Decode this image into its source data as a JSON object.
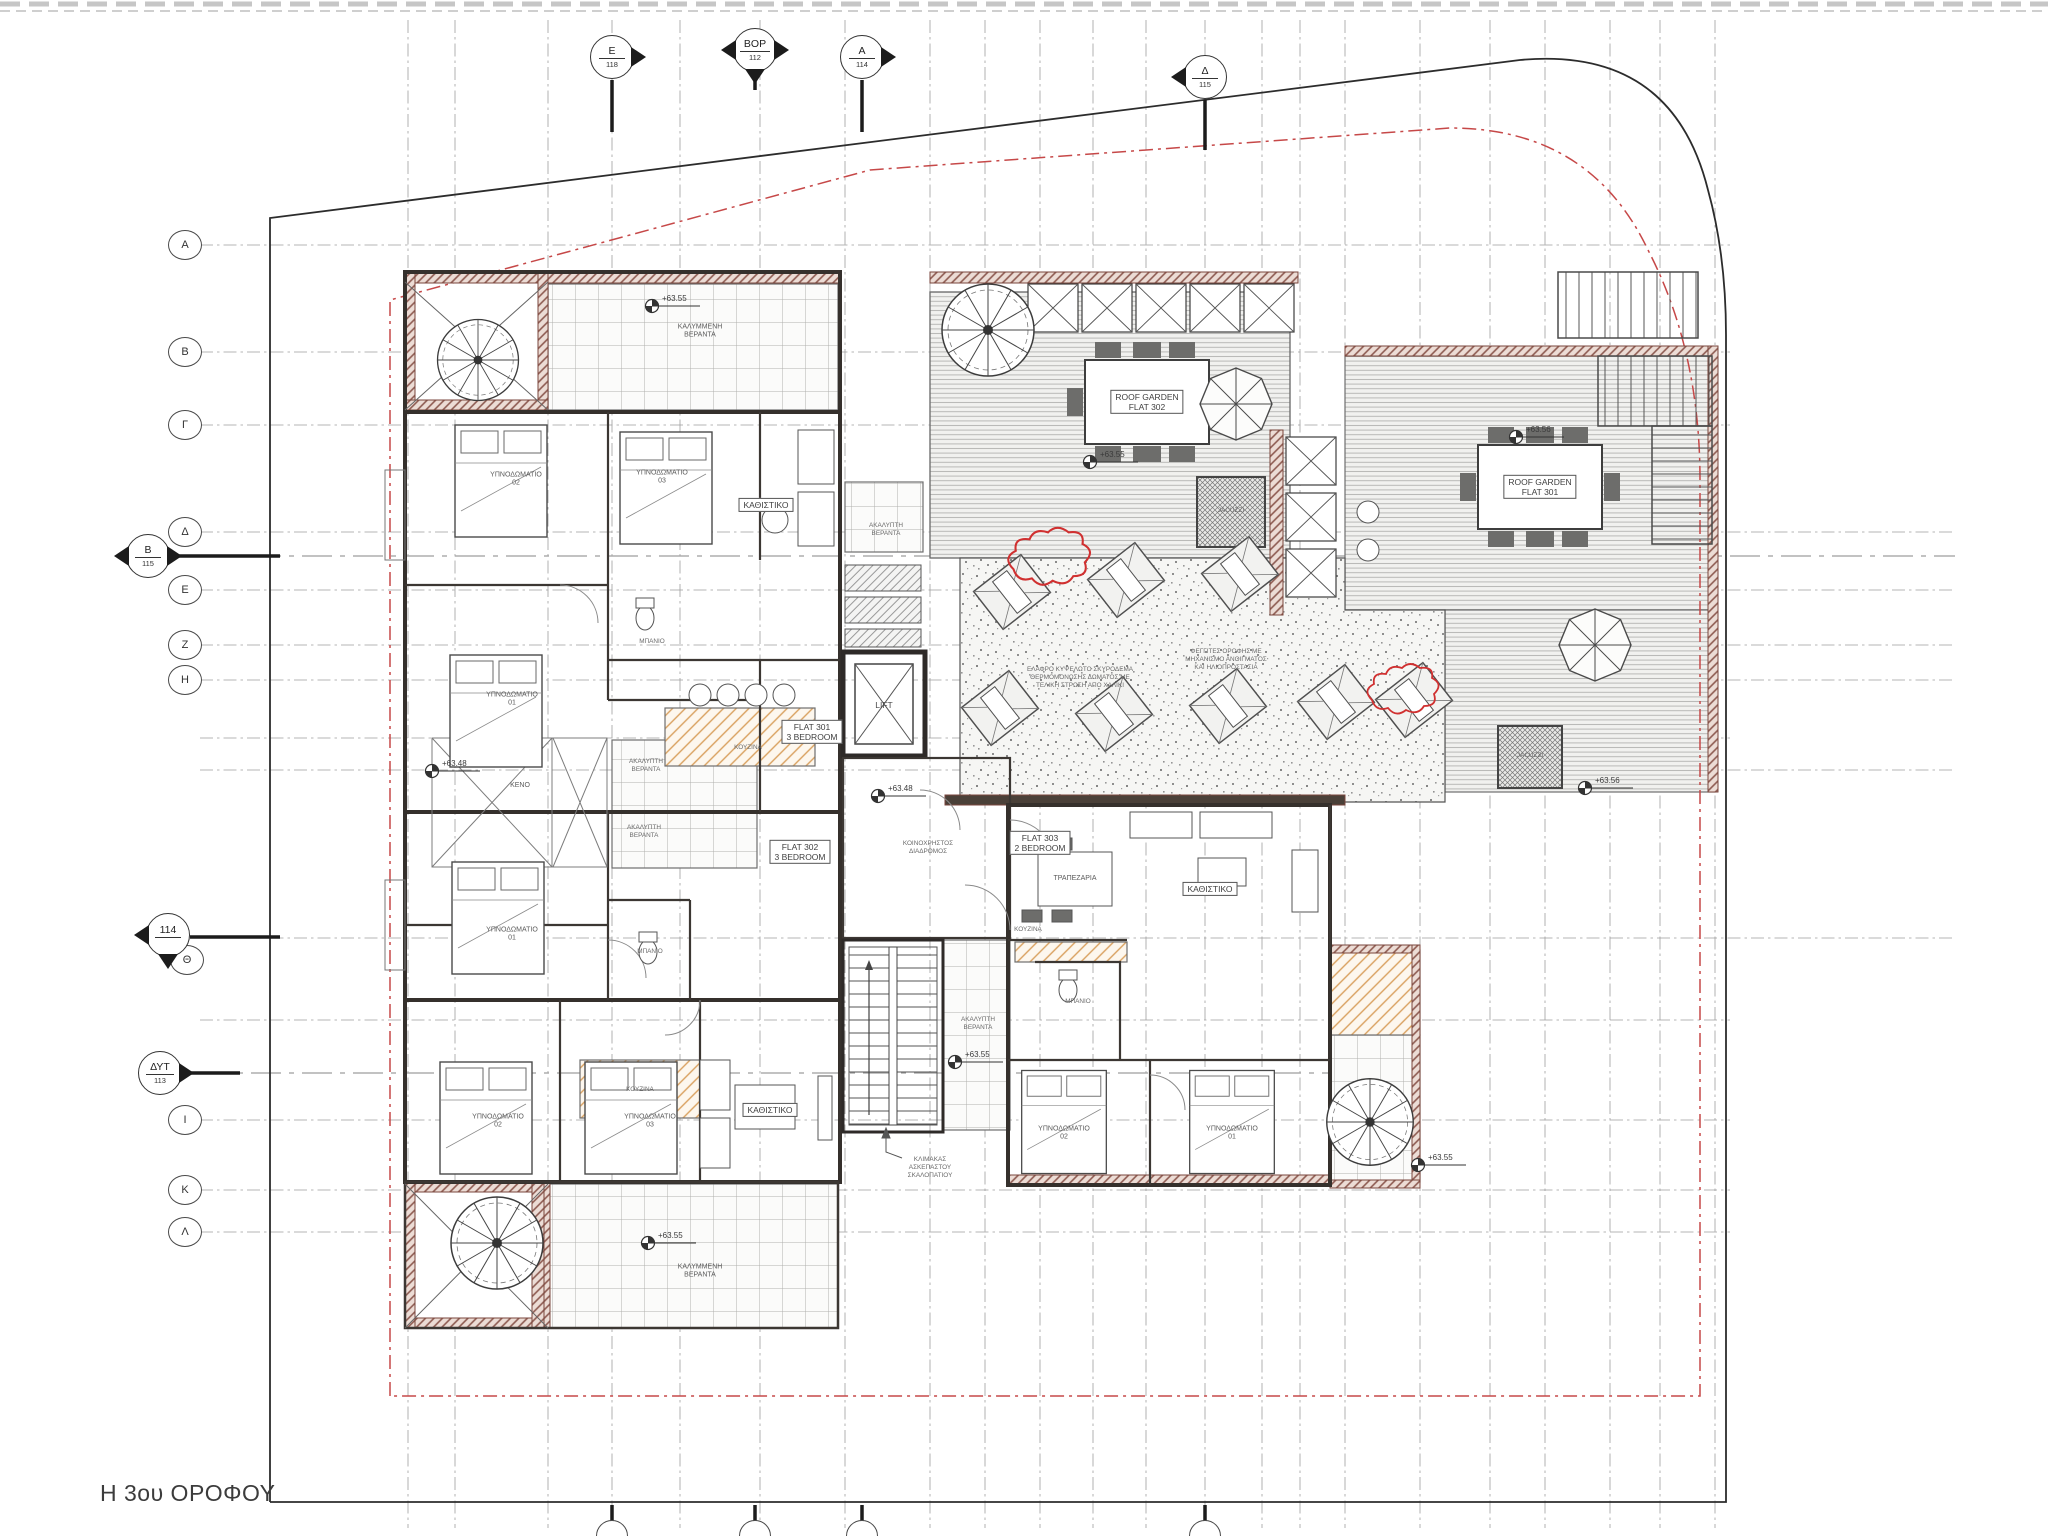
{
  "title": "Η 3ου ΟΡΟΦΟΥ",
  "grid": {
    "top": [
      {
        "l": "Ε",
        "n": "118"
      },
      {
        "l": "ΒΟΡ",
        "n": "112"
      },
      {
        "l": "Α",
        "n": "114"
      },
      {
        "l": "Δ",
        "n": "115"
      }
    ],
    "left": [
      "Α",
      "Β",
      "Γ",
      "Δ",
      "Ε",
      "Ζ",
      "Η",
      "Θ",
      "Ι",
      "Κ",
      "Λ"
    ],
    "sections": [
      {
        "l": "Β",
        "n": "115"
      },
      {
        "l": "114",
        "n": ""
      },
      {
        "l": "ΔΥΤ",
        "n": "113"
      }
    ]
  },
  "t": {
    "bedroom01": "ΥΠΝΟΔΩΜΑΤΙΟ\n01",
    "bedroom02": "ΥΠΝΟΔΩΜΑΤΙΟ\n02",
    "bedroom03": "ΥΠΝΟΔΩΜΑΤΙΟ\n03",
    "living": "ΚΑΘΙΣΤΙΚΟ",
    "dining": "ΤΡΑΠΕΖΑΡΙΑ",
    "kitchen": "ΚΟΥΖΙΝΑ",
    "bath": "ΜΠΑΝΙΟ",
    "lift": "LIFT",
    "void": "ΚΕΝΟ",
    "jacuzzi": "JACUZZI",
    "covered_veranda": "ΚΑΛΥΜΜΕΝΗ\nΒΕΡΑΝΤΑ",
    "open_veranda": "ΑΚΑΛΥΠΤΗ\nΒΕΡΑΝΤΑ",
    "common_corridor": "ΚΟΙΝΟΧΡΗΣΤΟΣ\nΔΙΑΔΡΟΜΟΣ",
    "roof_garden_302": "ROOF GARDEN\nFLAT 302",
    "roof_garden_301": "ROOF GARDEN\nFLAT 301",
    "flat301": "FLAT 301\n3 BEDROOM",
    "flat302": "FLAT 302\n3 BEDROOM",
    "flat303": "FLAT 303\n2 BEDROOM",
    "lvl_6348": "+63.48",
    "lvl_6355": "+63.55",
    "lvl_6356": "+63.56",
    "stair_note": "ΚΛΙΜΑΚΑΣ\nΑΣΚΕΠΑΣΤΟΥ\nΣΚΑΛΟΠΑΤΙΟΥ",
    "roof_note_1": "ΕΛΑΦΡΟ ΚΥΨΕΛΩΤΟ ΣΚΥΡΟΔΕΜΑ\nΘΕΡΜΟΜΟΝΩΣΗΣ ΔΩΜΑΤΟΣ ΜΕ\nΤΕΛΙΚΗ ΣΤΡΩΣΗ ΑΠΟ ΧΑΛΙΚΙ",
    "roof_note_2": "ΦΕΓΓΙΤΕΣ ΟΡΟΦΗΣ ΜΕ\nΜΗΧΑΝΙΣΜΟ ΑΝΟΙΓΜΑΤΟΣ\nΚΑΙ ΗΛΙΟΠΡΟΣΤΑΣΙΑ"
  },
  "colors": {
    "boundary_red": "#c64848",
    "wall_hatch": "#8d5a50",
    "accent_orange": "#d9a05e",
    "line_dark": "#2c2c2c",
    "grid_grey": "#9b9b9b"
  }
}
